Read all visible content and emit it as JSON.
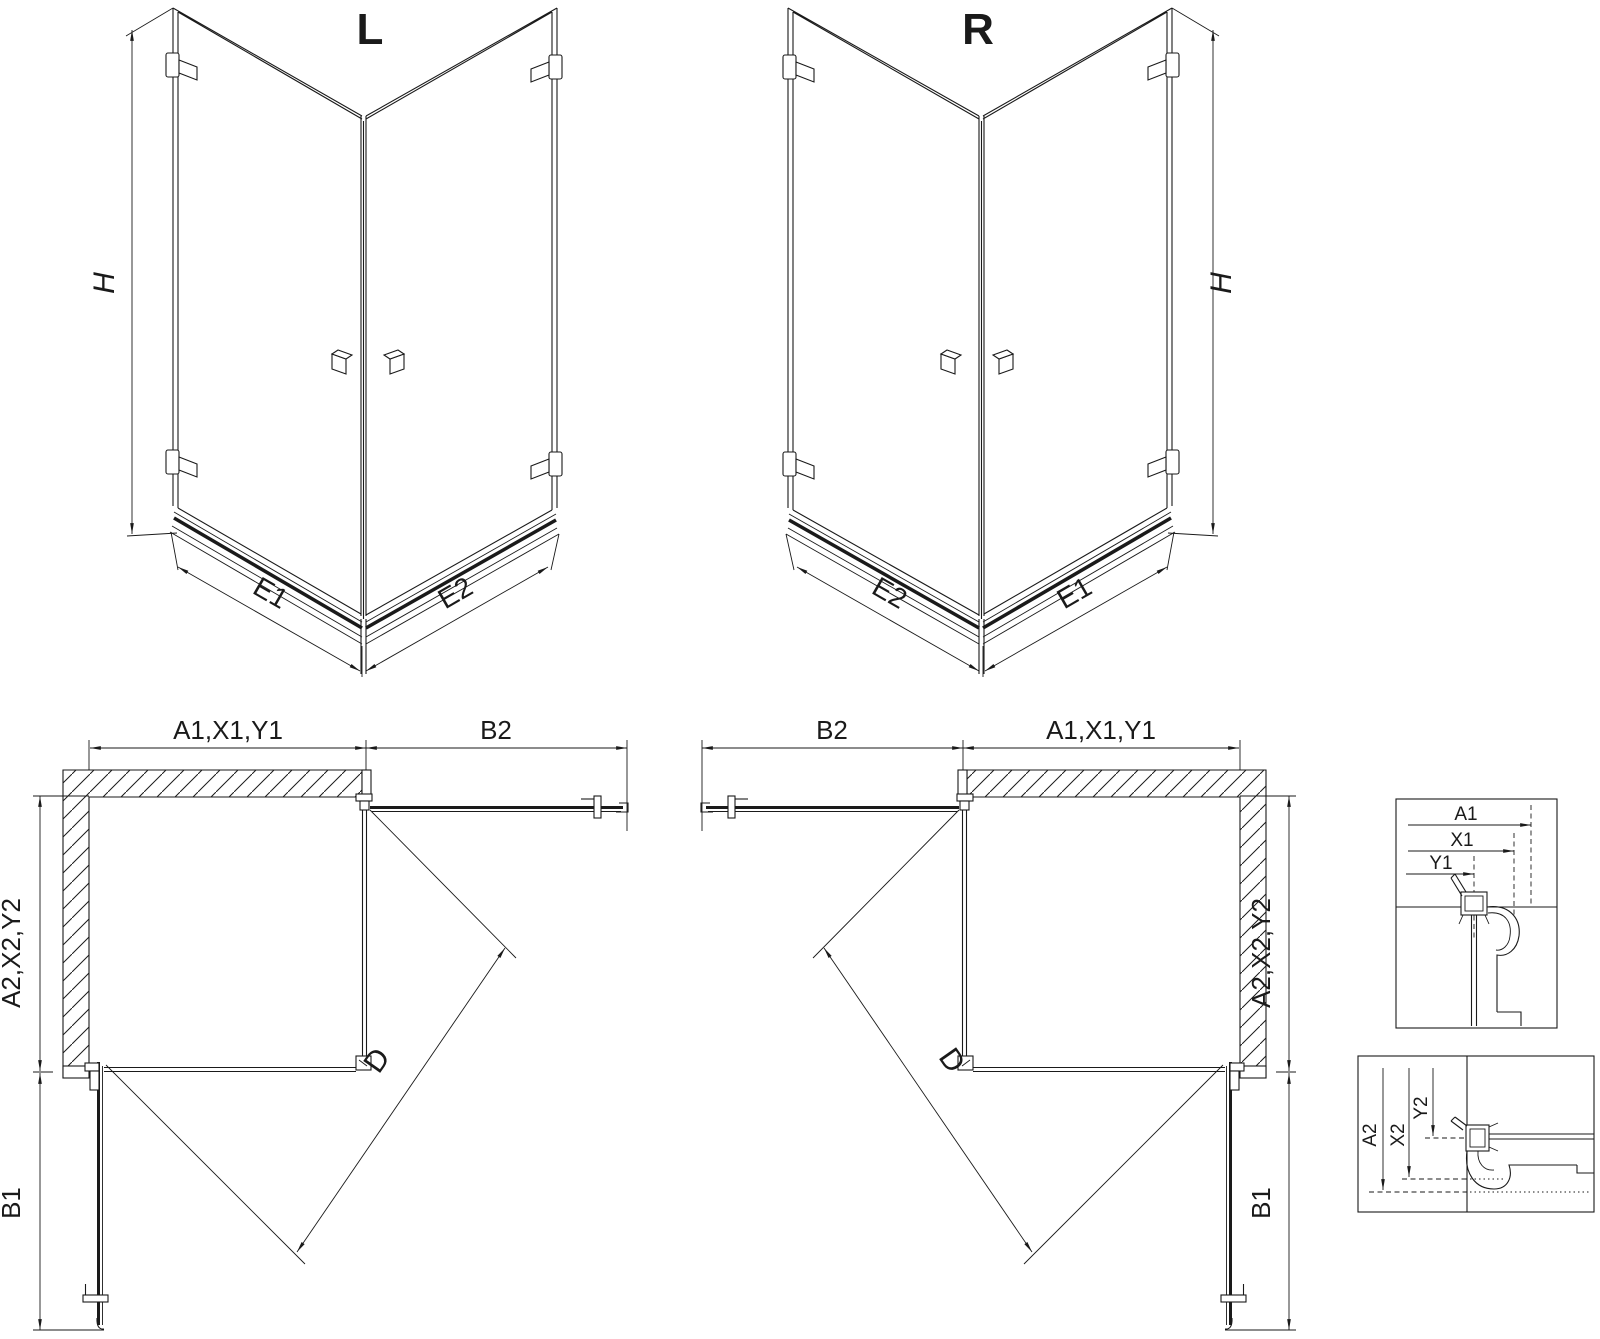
{
  "drawing": {
    "iso_left": {
      "title": "L",
      "dim_height": "H",
      "dim_edge_left": "E1",
      "dim_edge_right": "E2"
    },
    "iso_right": {
      "title": "R",
      "dim_height": "H",
      "dim_edge_left": "E2",
      "dim_edge_right": "E1"
    },
    "plan_left": {
      "dim_wall_width": "A1,X1,Y1",
      "dim_door_top": "B2",
      "dim_wall_depth": "A2,X2,Y2",
      "dim_door_side": "B1",
      "dim_diagonal": "D"
    },
    "plan_right": {
      "dim_wall_width": "A1,X1,Y1",
      "dim_door_top": "B2",
      "dim_wall_depth": "A2,X2,Y2",
      "dim_door_side": "B1",
      "dim_diagonal": "D"
    },
    "detail_wall_profile": {
      "dim_a": "A1",
      "dim_x": "X1",
      "dim_y": "Y1"
    },
    "detail_floor_profile": {
      "dim_a": "A2",
      "dim_x": "X2",
      "dim_y": "Y2"
    },
    "colors": {
      "line": "#1a1a1a",
      "background": "#ffffff"
    }
  }
}
